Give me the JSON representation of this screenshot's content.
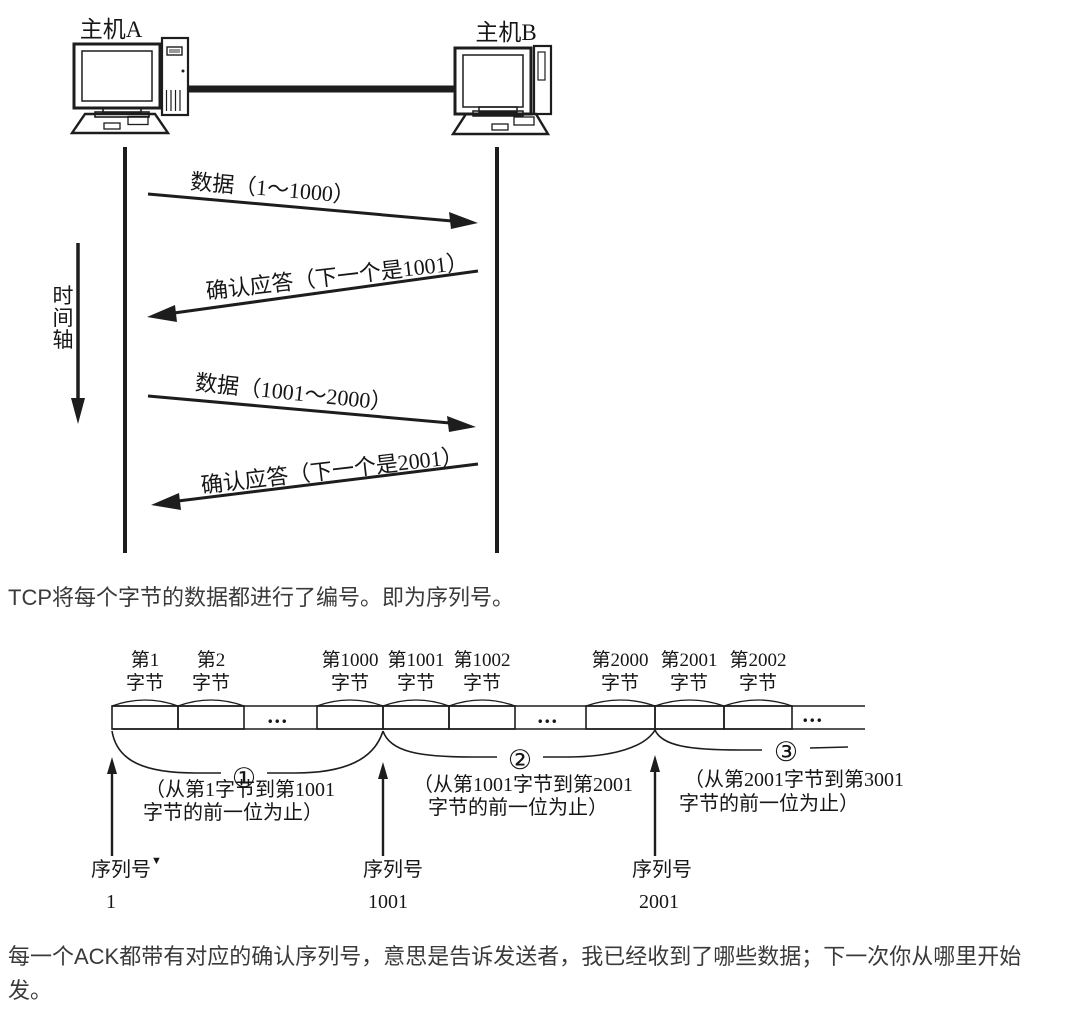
{
  "colors": {
    "background": "#ffffff",
    "diagram_ink": "#1d1d1d",
    "paragraph_text": "#3a3a3a"
  },
  "seq_diagram": {
    "host_a_label": "主机A",
    "host_b_label": "主机B",
    "time_axis_chars": [
      "时",
      "间",
      "轴"
    ],
    "messages": [
      {
        "label": "数据（1～1000）",
        "direction": "a-to-b"
      },
      {
        "label": "确认应答（下一个是1001）",
        "direction": "b-to-a"
      },
      {
        "label": "数据（1001～2000）",
        "direction": "a-to-b"
      },
      {
        "label": "确认应答（下一个是2001）",
        "direction": "b-to-a"
      }
    ]
  },
  "paragraph_1": "TCP将每个字节的数据都进行了编号。即为序列号。",
  "byte_diagram": {
    "byte_labels": [
      {
        "num": "第1",
        "unit": "字节"
      },
      {
        "num": "第2",
        "unit": "字节"
      },
      {
        "num": "第1000",
        "unit": "字节"
      },
      {
        "num": "第1001",
        "unit": "字节"
      },
      {
        "num": "第1002",
        "unit": "字节"
      },
      {
        "num": "第2000",
        "unit": "字节"
      },
      {
        "num": "第2001",
        "unit": "字节"
      },
      {
        "num": "第2002",
        "unit": "字节"
      }
    ],
    "ellipsis": "...",
    "sections": [
      {
        "num": "①",
        "line1": "（从第1字节到第1001",
        "line2": "字节的前一位为止）"
      },
      {
        "num": "②",
        "line1": "（从第1001字节到第2001",
        "line2": "字节的前一位为止）"
      },
      {
        "num": "③",
        "line1": "（从第2001字节到第3001",
        "line2": "字节的前一位为止）"
      }
    ],
    "seq_markers": [
      {
        "label": "序列号",
        "marker": "▼",
        "value": "1"
      },
      {
        "label": "序列号",
        "value": "1001"
      },
      {
        "label": "序列号",
        "value": "2001"
      }
    ]
  },
  "paragraph_2": "每一个ACK都带有对应的确认序列号，意思是告诉发送者，我已经收到了哪些数据；下一次你从哪里开始发。"
}
